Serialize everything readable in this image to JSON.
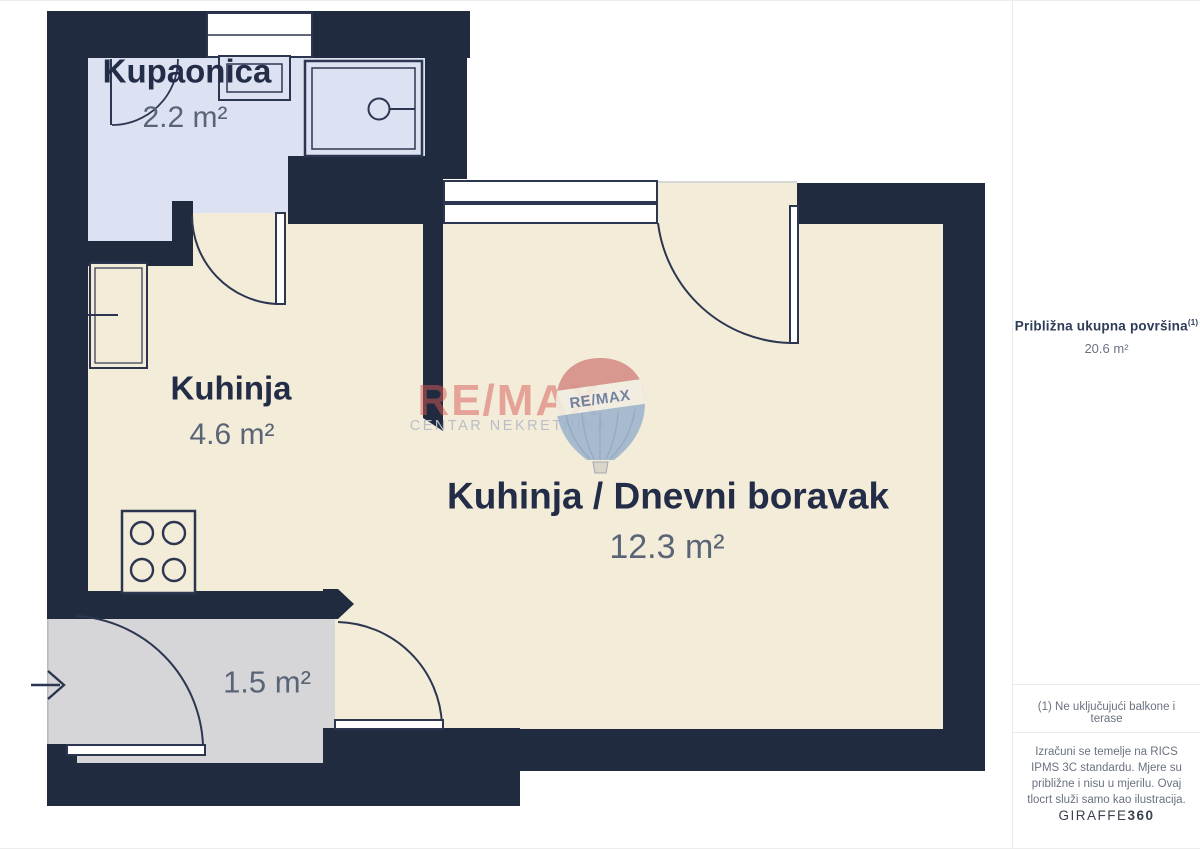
{
  "floorplan": {
    "rooms": {
      "bathroom": {
        "name": "Kupaonica",
        "area": "2.2 m²"
      },
      "kitchen": {
        "name": "Kuhinja",
        "area": "4.6 m²"
      },
      "living": {
        "name": "Kuhinja / Dnevni boravak",
        "area": "12.3 m²"
      },
      "entry": {
        "area": "1.5 m²"
      }
    },
    "watermark": {
      "brand": "RE/MAX",
      "subtitle": "CENTAR NEKRETNINA",
      "balloon_label": "RE/MAX"
    },
    "colors": {
      "wall": "#202b40",
      "floor_main": "#f3ecd8",
      "floor_bathroom": "#dce2f2",
      "floor_entry": "#d6d6d9",
      "brand_red": "#d9655e",
      "balloon_blue": "#9fb5ce"
    }
  },
  "sidebar": {
    "total_area_label": "Približna ukupna površina",
    "total_area_note_ref": "(1)",
    "total_area_value": "20.6 m²",
    "footnote": "(1) Ne uključujući balkone i terase",
    "disclaimer": "Izračuni se temelje na RICS IPMS 3C standardu. Mjere su približne i nisu u mjerilu. Ovaj tlocrt služi samo kao ilustracija.",
    "brand_name": "GIRAFFE",
    "brand_suffix": "360"
  }
}
